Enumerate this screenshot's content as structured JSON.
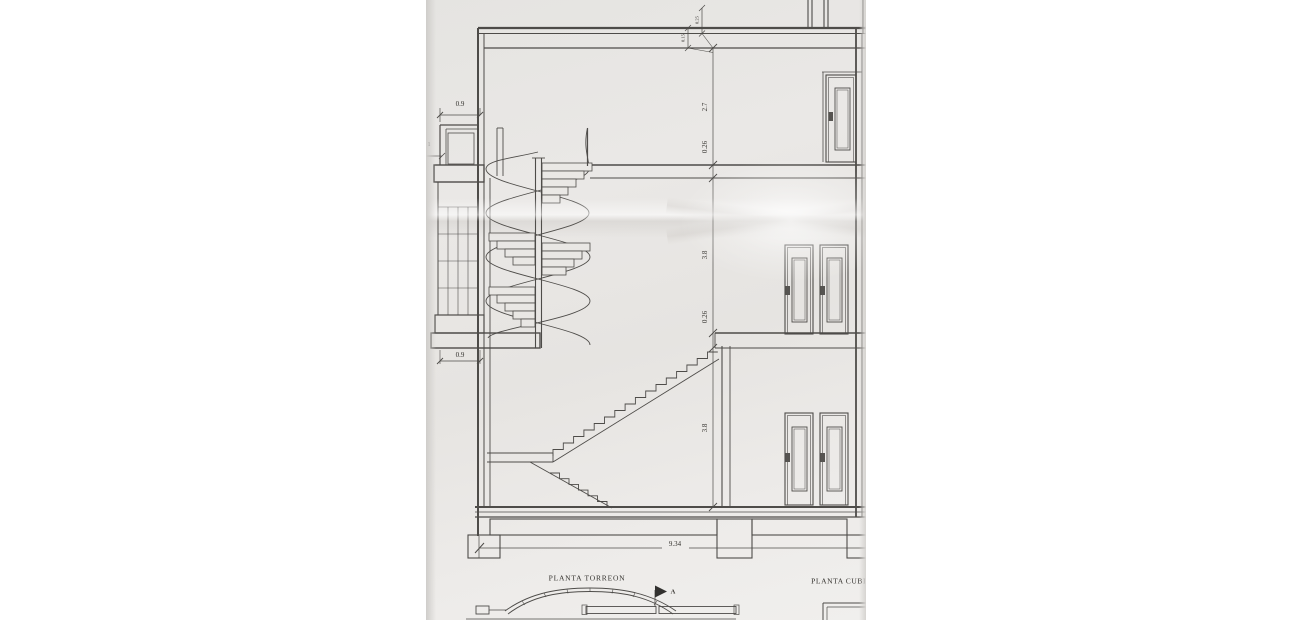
{
  "drawing": {
    "section_dimensions": {
      "balcony_width_top": "0.9",
      "balcony_edge": "1",
      "parapet_small_a": "0.25",
      "parapet_small_b": "0.15",
      "upper_room_height": "2.7",
      "upper_slab": "0.26",
      "middle_room_height": "3.8",
      "lower_slab": "0.26",
      "lower_room_height": "3.8",
      "balcony_width_bottom": "0.9",
      "overall_width": "9.34"
    },
    "plan_titles": {
      "left": "PLANTA TORREON",
      "right": "PLANTA CUBIER"
    },
    "section_marker": "A"
  }
}
